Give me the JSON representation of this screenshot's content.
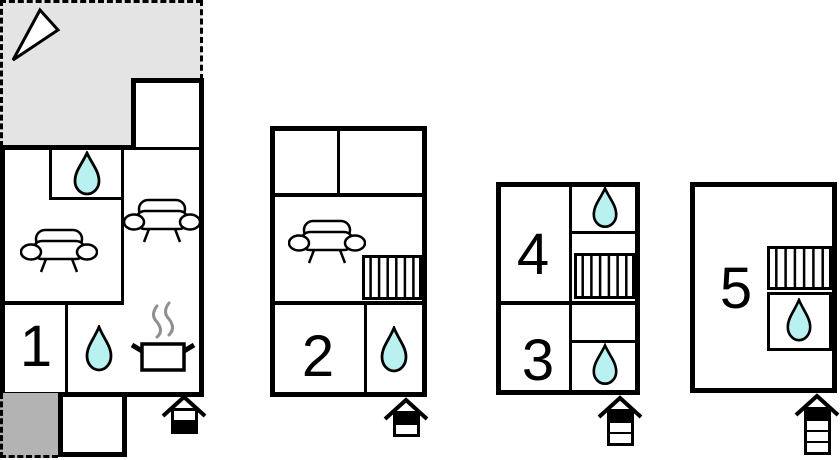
{
  "page": {
    "type": "holiday-home-floor-plan"
  },
  "colors": {
    "wall": "#000000",
    "background": "#ffffff",
    "terrace_light": "#e4e4e4",
    "terrace_dark": "#b3b3b3",
    "water": "#b9f1f1",
    "steam": "#8f8f8f"
  },
  "units": [
    {
      "label": "1",
      "features": [
        "terrace",
        "bathroom-upper",
        "sofa-living-room",
        "sofa-second",
        "kitchen-stove",
        "bathroom-lower",
        "annex-room",
        "small-terrace",
        "entrance"
      ]
    },
    {
      "label": "2",
      "features": [
        "two-upper-rooms",
        "sofa-living-room",
        "stairs",
        "bathroom",
        "entrance"
      ]
    },
    {
      "label": "3",
      "features": [
        "room",
        "bathroom",
        "shared-stairs"
      ]
    },
    {
      "label": "4",
      "features": [
        "room",
        "bathroom",
        "stairs"
      ]
    },
    {
      "label": "5",
      "features": [
        "room",
        "stairs",
        "bathroom",
        "entrance"
      ]
    }
  ],
  "entrances": [
    {
      "unit": "1",
      "floors": [
        "white",
        "black"
      ]
    },
    {
      "unit": "2",
      "floors": [
        "black",
        "white"
      ]
    },
    {
      "unit": "3-4",
      "floors": [
        "black",
        "white",
        "white"
      ]
    },
    {
      "unit": "5",
      "floors": [
        "black",
        "white",
        "white",
        "white"
      ]
    }
  ],
  "icons": {
    "north_arrow": "orientation-triangle",
    "water_drop": "bathroom-shower",
    "sofa": "living-room-seating",
    "stairs": "staircase",
    "stove": "kitchen-pot-with-steam",
    "entrance_arrow": "entrance-with-floor-indicator"
  }
}
